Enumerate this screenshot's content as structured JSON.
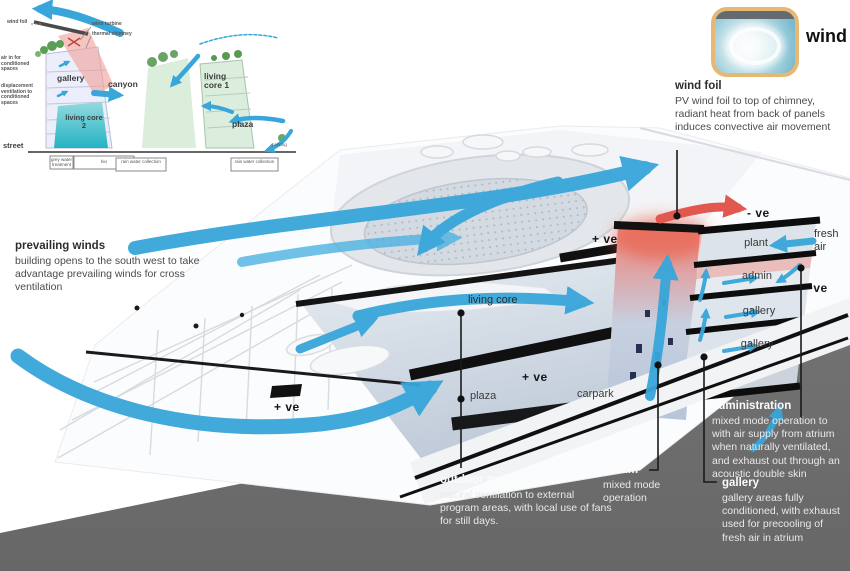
{
  "colors": {
    "arrow_blue": "#38a6da",
    "arrow_red": "#e2574e",
    "ground_gray": "#6e6e6e",
    "chip_border_tan": "#e7b873",
    "teal_core": "#23b3c3"
  },
  "wind_card": {
    "label": "wind"
  },
  "callouts": {
    "wind_foil": {
      "title": "wind foil",
      "body": "PV wind foil to top of chimney, radiant heat from back of panels induces convective air movement"
    },
    "prevailing_winds": {
      "title": "prevailing winds",
      "body": "building opens to the south west to take advantage prevailing winds for cross ventilation"
    },
    "outdoor_program": {
      "title": "outdoor program",
      "body": "natural ventilation to external program areas, with local use of fans for still days."
    },
    "atrium": {
      "title": "atrium",
      "body": "mixed mode operation"
    },
    "administration": {
      "title": "administration",
      "body": "mixed mode operation to with air supply from atrium when naturally ventilated, and exhaust out through an acoustic double skin"
    },
    "gallery": {
      "title": "gallery",
      "body": "gallery areas fully conditioned, with exhaust used for precooling of fresh air in atrium"
    }
  },
  "building": {
    "floors": [
      {
        "label": "plant"
      },
      {
        "label": "admin"
      },
      {
        "label": "gallery"
      },
      {
        "label": "gallery"
      }
    ],
    "interior_labels": {
      "living_core": "living core",
      "plaza": "plaza",
      "carpark": "carpark"
    },
    "pressure": {
      "neg_top": "- ve",
      "neg_right": "- ve",
      "pos_center": "+ ve",
      "pos_mid": "+ ve",
      "pos_left": "+ ve"
    },
    "fresh_air": "fresh air"
  },
  "inset": {
    "labels": {
      "wind_foil": "wind foil",
      "wind_turbine": "wind turbine",
      "thermal_chimney": "thermal chimney",
      "air_in": "air in for conditioned spaces",
      "displacement": "displacement ventilation to conditioned spaces",
      "gallery": "gallery",
      "canyon": "canyon",
      "living_core_2": "living core 2",
      "living_core_1": "living core 1",
      "plaza": "plaza",
      "street": "street",
      "parking": "parking",
      "grey_water": "grey water treatment",
      "bio": "bio",
      "rain_water_1": "rain water collection",
      "rain_water_2": "rain water collection"
    }
  }
}
